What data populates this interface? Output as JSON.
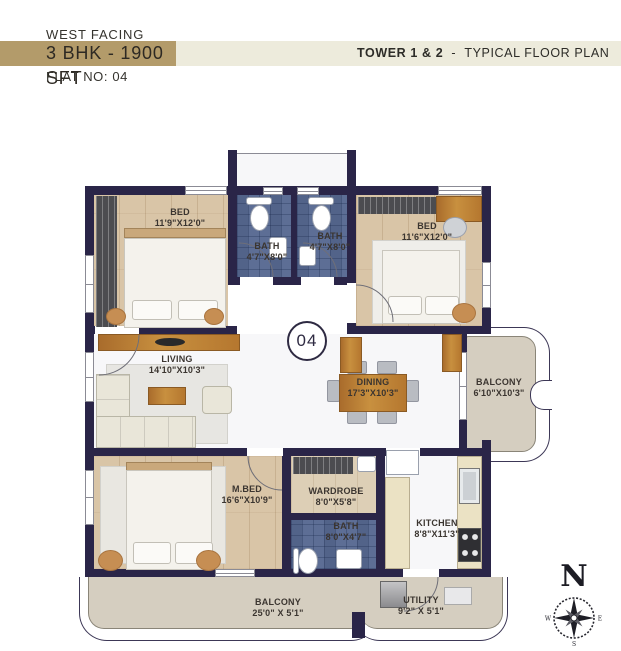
{
  "header": {
    "facing": "WEST FACING",
    "unit_type": "3 BHK - 1900 SFT",
    "tower": "TOWER 1 & 2",
    "separator": "-",
    "plan_type": "TYPICAL FLOOR PLAN",
    "flat_no": "FLAT NO: 04"
  },
  "plan": {
    "unit_number": "04",
    "rooms": {
      "bed1": {
        "name": "BED",
        "dims": "11'9\"X12'0\""
      },
      "bath1": {
        "name": "BATH",
        "dims": "4'7\"X8'0\""
      },
      "bath2": {
        "name": "BATH",
        "dims": "4'7\"X8'0\""
      },
      "bed2": {
        "name": "BED",
        "dims": "11'6\"X12'0\""
      },
      "living": {
        "name": "LIVING",
        "dims": "14'10\"X10'3\""
      },
      "dining": {
        "name": "DINING",
        "dims": "17'3\"X10'3\""
      },
      "balcony_right": {
        "name": "BALCONY",
        "dims": "6'10\"X10'3\""
      },
      "mbed": {
        "name": "M.BED",
        "dims": "16'6\"X10'9\""
      },
      "wardrobe": {
        "name": "WARDROBE",
        "dims": "8'0\"X5'8\""
      },
      "bath3": {
        "name": "BATH",
        "dims": "8'0\"X4'7\""
      },
      "kitchen": {
        "name": "KITCHEN",
        "dims": "8'8\"X11'3\""
      },
      "balcony_bottom": {
        "name": "BALCONY",
        "dims": "25'0\" X 5'1\""
      },
      "utility": {
        "name": "UTILITY",
        "dims": "9'2\" X 5'1\""
      }
    },
    "compass": {
      "n": "N",
      "e": "E",
      "s": "S",
      "w": "W"
    }
  },
  "palette": {
    "wall": "#2a2548",
    "banner_gold": "#b39b6a",
    "banner_cream": "#edebdc",
    "wood_floor": "#d9c5a7",
    "bath_tile": "#5d6e95",
    "balcony_floor": "#d5cec0",
    "text": "#3b3530"
  }
}
